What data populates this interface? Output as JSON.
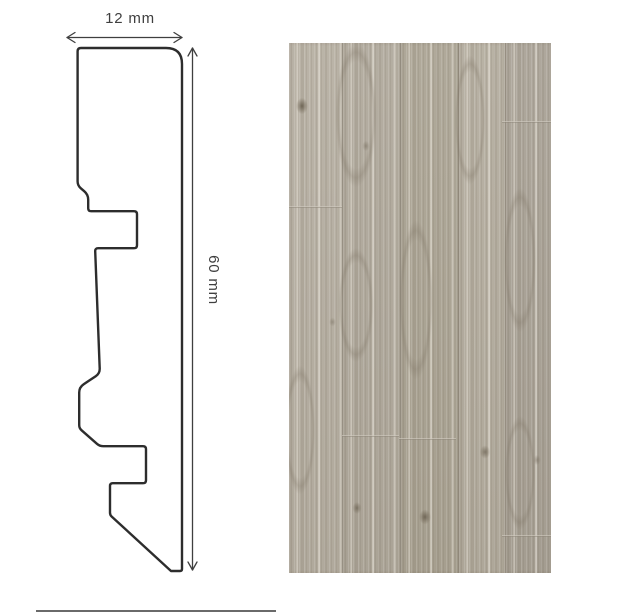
{
  "diagram": {
    "width_label": "12 mm",
    "height_label": "60 mm"
  },
  "colors": {
    "outline": "#2d2d2d",
    "dim": "#3f3f3f",
    "text": "#3f3f3f",
    "divider": "#6a6a6a",
    "wood_base": "#b2ab9e",
    "seam": "rgba(95,87,74,0.35)"
  },
  "wood": {
    "planks": [
      {
        "w": 53,
        "tint": "#b6afa2",
        "shift": "0px"
      },
      {
        "w": 57,
        "tint": "#b0a99c",
        "shift": "5px"
      },
      {
        "w": 57,
        "tint": "#aba494",
        "shift": "11px"
      },
      {
        "w": 46,
        "tint": "#b4ad9f",
        "shift": "3px"
      },
      {
        "w": 49,
        "tint": "#a9a296",
        "shift": "8px"
      }
    ],
    "arches": [
      {
        "x": 67,
        "y": 72,
        "w": 54,
        "h": 190
      },
      {
        "x": 67,
        "y": 262,
        "w": 46,
        "h": 150
      },
      {
        "x": 127,
        "y": 257,
        "w": 44,
        "h": 210
      },
      {
        "x": 181,
        "y": 77,
        "w": 40,
        "h": 170
      },
      {
        "x": 231,
        "y": 217,
        "w": 42,
        "h": 190
      },
      {
        "x": 11,
        "y": 387,
        "w": 40,
        "h": 170
      },
      {
        "x": 231,
        "y": 430,
        "w": 40,
        "h": 150
      }
    ],
    "knots": [
      {
        "x": 13,
        "y": 63,
        "w": 16,
        "h": 22,
        "o": 0.9
      },
      {
        "x": 77,
        "y": 103,
        "w": 10,
        "h": 14,
        "o": 0.45
      },
      {
        "x": 43,
        "y": 279,
        "w": 9,
        "h": 12,
        "o": 0.4
      },
      {
        "x": 68,
        "y": 465,
        "w": 12,
        "h": 16,
        "o": 0.7
      },
      {
        "x": 136,
        "y": 474,
        "w": 16,
        "h": 20,
        "o": 0.85
      },
      {
        "x": 196,
        "y": 409,
        "w": 14,
        "h": 18,
        "o": 0.7
      },
      {
        "x": 248,
        "y": 417,
        "w": 10,
        "h": 14,
        "o": 0.45
      }
    ],
    "joints": [
      {
        "x": 0,
        "y": 163,
        "w": 53
      },
      {
        "x": 213,
        "y": 78,
        "w": 49
      },
      {
        "x": 110,
        "y": 395,
        "w": 57
      },
      {
        "x": 53,
        "y": 392,
        "w": 57
      },
      {
        "x": 213,
        "y": 492,
        "w": 49
      }
    ]
  }
}
